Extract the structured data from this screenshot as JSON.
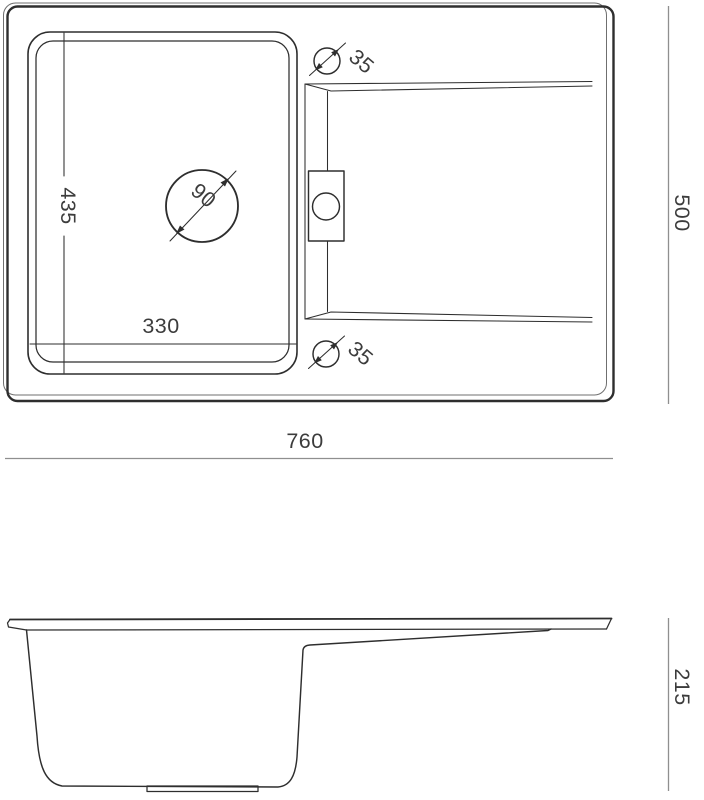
{
  "drawing": {
    "top_view": {
      "bowl_depth": "435",
      "bowl_width": "330",
      "drain_diameter": "90",
      "hole_top_diameter": "35",
      "hole_bottom_diameter": "35"
    },
    "overall": {
      "width": "760",
      "depth": "500",
      "height": "215"
    },
    "icons": {
      "hole_top": "diameter-symbol-circle-slash",
      "hole_bottom": "diameter-symbol-circle-slash",
      "drain": "drain-circle-with-diameter-arrows"
    },
    "colors": {
      "line": "#2e2e2e",
      "thin_line": "#6f6f6f",
      "dimension_line": "#8f8f8f",
      "text": "#3c3c3c",
      "background": "#ffffff"
    }
  }
}
